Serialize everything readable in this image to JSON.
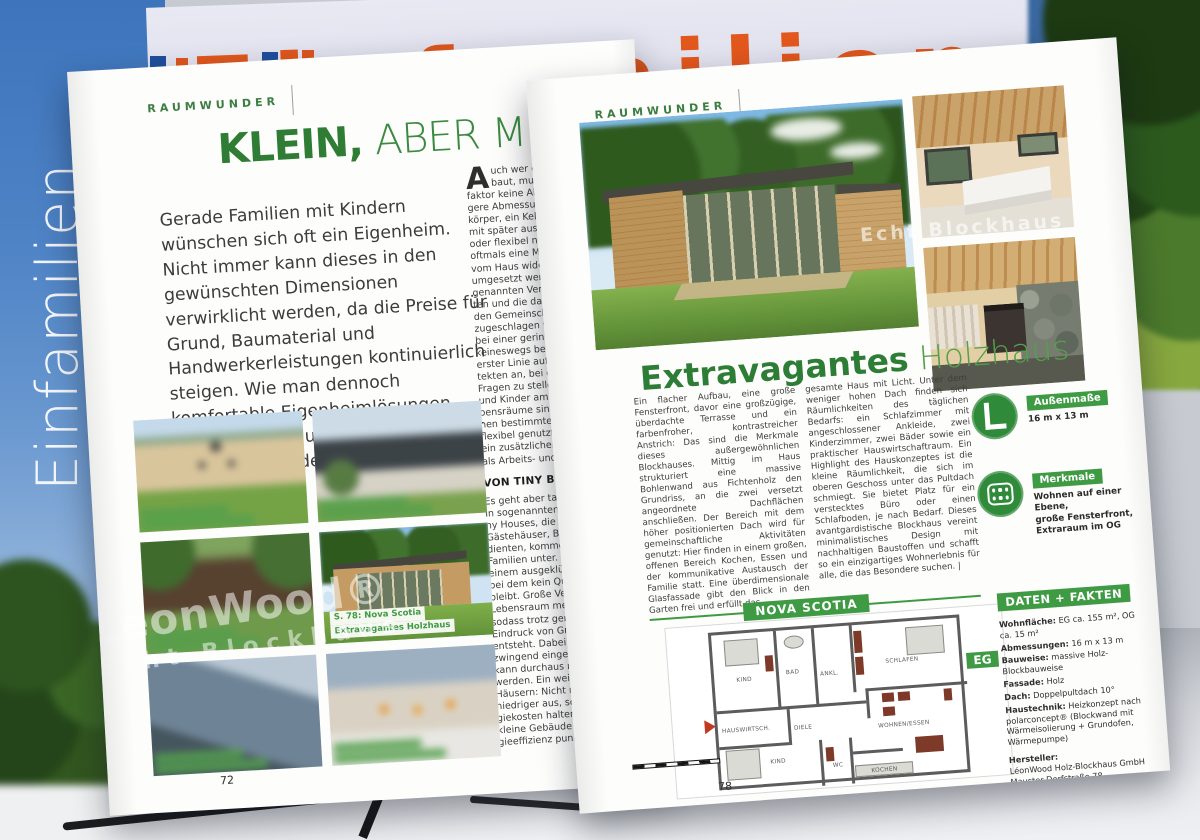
{
  "cover": {
    "line1": "Einfamilien",
    "line2_bold": "Häuser",
    "line2_thin": "|2026"
  },
  "backdrop": {
    "cropped_title": "Einfamilien"
  },
  "watermark": {
    "brand": "LéonWood®",
    "tagline": "Echt Blockhaus"
  },
  "left_page": {
    "section_label": "RAUMWUNDER",
    "headline": {
      "bold": "KLEIN,",
      "light": " ABER MEIN!"
    },
    "intro": "Gerade Familien mit Kindern wünschen sich oft ein Eigenheim. Nicht immer kann dieses in den gewünschten Dimensionen verwirklicht werden, da die Preise für Grund, Baumaterial und Handwerkerleistungen kontinuierlich steigen. Wie man dennoch komfortable Eigenheimlösungen schafft, zeigen unsere Raumwunder auf den folgenden Seiten.",
    "column": {
      "dropcap": "A",
      "para1_start": "uch wer eine Numm\nbaut, muss beim Gem",
      "para1_rest": "faktor keine Abstriche mac\ngere Abmessungen, ein kom\nkörper, ein Keller oder Da\nmit später ausbaubaren Ra\noder flexibel nutzbare Zimm\noftmals eine Möglichkeit, w\nvom Haus wider Erwarten\numgesetzt werden kann. W\ngenannten Verkehrsflächen\nten und die dadurch gewon\nden Gemeinschafts- oder P\nzugeschlagen wird, fühlt m\nbei einer geringeren Quadr\nkeineswegs beengt. Hier k\nerster Linie auf die Expertis\ntekten an, bei der Planung\nFragen zu stellen: Wo halte\nund Kinder am liebsten auf\nbensräume sind ihnen wich\nnen bestimmte Zimmer n\nflexibel genutzt werden, z\nein zusätzlicher Raum im E\nals Arbeits- und als Gästezim",
      "subhead": "VON TINY BIS MINI",
      "para2": "Es geht aber tatsächlich auc\nIn sogenannten Mini-Häus\nny Houses, die früher in ers\nGästehäuser, Büro- oder F\ndienten, kommen heute s\nFamilien unter. Zu verdan\neinem ausgeklügelten Rau\nbei dem kein Quadratmete\nbleibt. Große Verglasungen\nLebensraum meist in Richt\nsodass trotz geringer Woh\nEindruck von Großzügigkei\nentsteht. Dabei muss ein Mi\nzwingend eingeschossig se\nkann durchaus mit zwei Eta\nwerden. Ein weiterer Vorteil\nHäusern: Nicht nur die Bauk\nniedriger aus, sondern auc\ngiekosten halten sich in G\nkleine Gebäude mit einer h\ngieeffizienz punkten. |"
    },
    "gallery_caption": {
      "line1": "S. 78: Nova Scotia",
      "line2": "Extravagantes Holzhaus"
    },
    "page_number": "72"
  },
  "right_page": {
    "section_label": "RAUMWUNDER",
    "title": {
      "bold": "Extravagantes",
      "light": " Holzhaus"
    },
    "body_col1": "Ein flacher Aufbau, eine große Fensterfront, davor eine großzügige, überdachte Terrasse und ein farbenfroher, kontrastreicher Anstrich: Das sind die Merkmale dieses außergewöhnlichen Blockhauses. Mittig im Haus strukturiert eine massive Bohlenwand aus Fichtenholz den Grundriss, an die zwei versetzt angeordnete Dachflächen anschließen. Der Bereich mit dem höher positionierten Dach wird für gemeinschaftliche Aktivitäten genutzt: Hier finden in einem großen, offenen Bereich Kochen, Essen und der kommunikative Austausch der Familie statt. Eine überdimensionale Glasfassade gibt den Blick in den Garten frei und erfüllt das",
    "body_col2": "gesamte Haus mit Licht. Unter dem weniger hohen Dach finden sich Räumlichkeiten des täglichen Bedarfs: ein Schlafzimmer mit angeschlossener Ankleide, zwei Kinderzimmer, zwei Bäder sowie ein praktischer Hauswirtschaftraum. Ein Highlight des Hauskonzeptes ist die kleine Räumlichkeit, die sich im oberen Geschoss unter das Pultdach schmiegt. Sie bietet Platz für ein verstecktes Büro oder einen Schlafboden, je nach Bedarf. Dieses avantgardistische Blockhaus vereint minimalistisches Design mit nachhaltigen Baustoffen und schafft so ein einzigartiges Wohnerlebnis für alle, die das Besondere suchen. |",
    "badges": [
      {
        "label": "Außenmaße",
        "text": "16 m x 13 m"
      },
      {
        "label": "Merkmale",
        "text": "Wohnen auf einer Ebene,\ngroße Fensterfront,\nExtraraum im OG"
      }
    ],
    "plan": {
      "model_name": "NOVA SCOTIA",
      "floor_label": "EG",
      "rooms": {
        "kind_top": "KIND",
        "bad": "BAD",
        "ankleide": "ANKL.",
        "schlafen": "SCHLAFEN",
        "hauswirtschaft": "HAUSWIRTSCH.",
        "diele": "DIELE",
        "kind_bottom": "KIND",
        "wc": "WC",
        "wohnen_essen": "WOHNEN/ESSEN",
        "kochen": "KOCHEN"
      }
    },
    "facts": {
      "heading": "DATEN + FAKTEN",
      "rows": [
        {
          "label": "Wohnfläche:",
          "value": "EG ca. 155 m², OG ca. 15 m²"
        },
        {
          "label": "Abmessungen:",
          "value": "16 m x 13 m"
        },
        {
          "label": "Bauweise:",
          "value": "massive Holz-Blockbauweise"
        },
        {
          "label": "Fassade:",
          "value": "Holz"
        },
        {
          "label": "Dach:",
          "value": "Doppelpultdach 10°"
        },
        {
          "label": "Haustechnik:",
          "value": "Heizkonzept nach polarconcept® (Blockwand mit Wärmeisolierung + Grundofen, Wärmepumpe)"
        }
      ],
      "manufacturer_label": "Hersteller:",
      "manufacturer": "LéonWood Holz-Blockhaus GmbH\nMauster Dorfstraße 78\n03185 Teichland OT Maust\nTel: 03 56 01/8 88 88\nleonwoodzentrale@leonwood.de\nwww.leonwood.de"
    },
    "page_number": "78"
  },
  "colors": {
    "accent_green": "#3f9a44",
    "headline_green": "#2f7c34",
    "cover_orange": "#e2571c",
    "cover_blue": "#3d74bc"
  }
}
